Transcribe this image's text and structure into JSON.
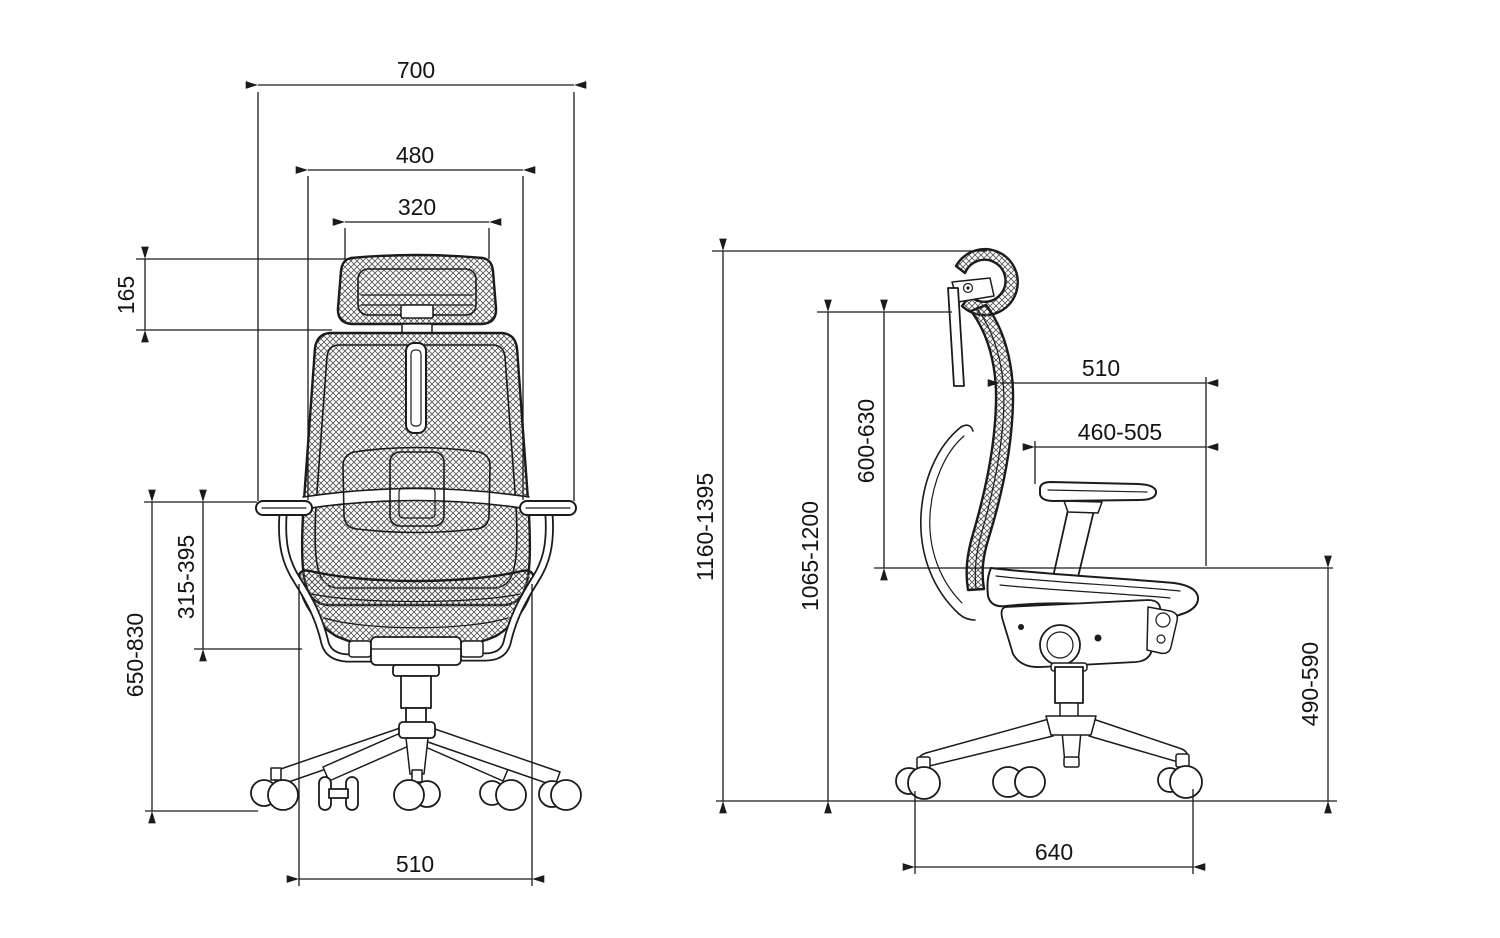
{
  "colors": {
    "background": "#ffffff",
    "line": "#1b1b1b",
    "mesh_hatch": "#555555"
  },
  "back_view": {
    "dims": {
      "overall_width": "700",
      "backrest_width": "480",
      "headrest_width": "320",
      "headrest_height": "165",
      "armrest_above_seat": "315-395",
      "armrest_to_floor": "650-830",
      "seat_width": "510"
    }
  },
  "side_view": {
    "dims": {
      "overall_height": "1160-1395",
      "backrest_top_to_floor": "1065-1200",
      "backrest_height": "600-630",
      "seat_depth": "510",
      "armrest_reach": "460-505",
      "seat_height": "490-590",
      "base_depth": "640"
    }
  }
}
